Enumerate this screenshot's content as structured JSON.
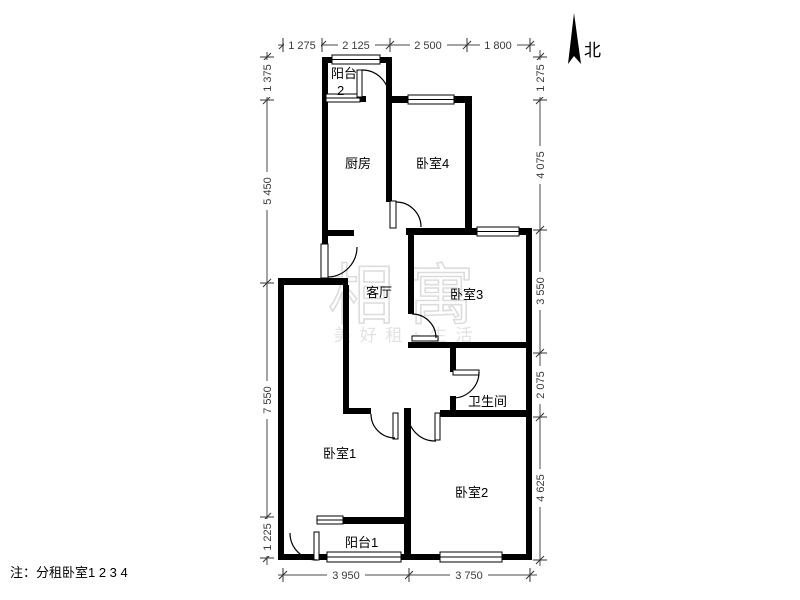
{
  "north_label": "北",
  "note": "注：分租卧室1 2 3 4",
  "watermark": {
    "main": "相寓",
    "sub": "美 好 租 + 生 活"
  },
  "rooms": {
    "balcony2_line1": "阳台",
    "balcony2_line2": "2",
    "kitchen": "厨房",
    "bedroom4": "卧室4",
    "living": "客厅",
    "bedroom3": "卧室3",
    "bathroom": "卫生间",
    "bedroom1": "卧室1",
    "bedroom2": "卧室2",
    "balcony1": "阳台1"
  },
  "dimensions": {
    "top": [
      "1 275",
      "2 125",
      "2 500",
      "1 800"
    ],
    "left": [
      "1 375",
      "5 450",
      "7 550",
      "1 225"
    ],
    "right": [
      "1 275",
      "4 075",
      "3 550",
      "2 075",
      "4 625"
    ],
    "bottom": [
      "3 950",
      "3 750"
    ]
  },
  "colors": {
    "wall": "#000000",
    "dimension": "#3a3a3a",
    "watermark": "#dcdcdc"
  }
}
